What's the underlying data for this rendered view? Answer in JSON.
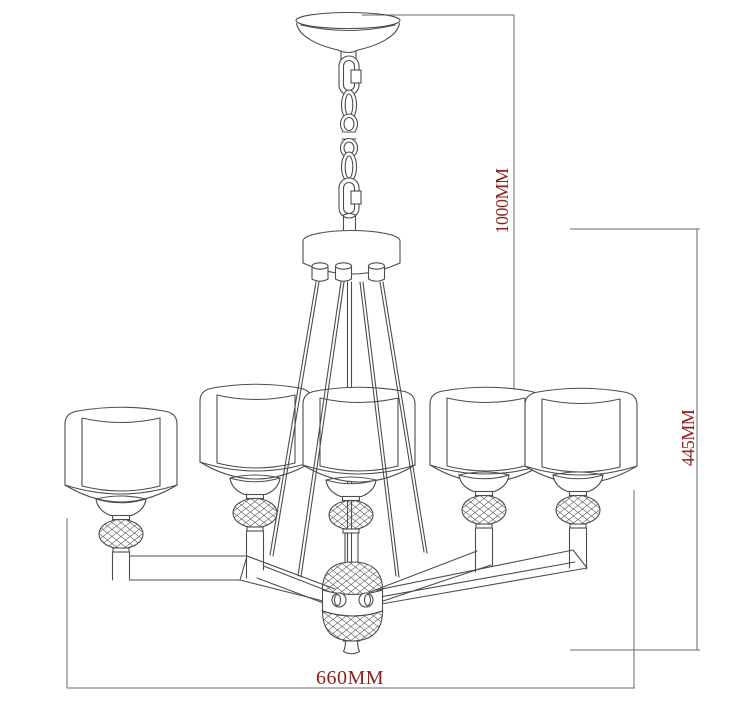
{
  "diagram": {
    "title": "chandelier-dimension-drawing",
    "type": "technical line drawing",
    "style": {
      "background": "#ffffff",
      "line_color": "#4d4d4d",
      "dimension_line_color": "#6a6a6a",
      "dimension_text_color": "#8f2020"
    },
    "dimensions": {
      "overall_drop": {
        "label": "1000MM",
        "orientation": "vertical"
      },
      "body_height": {
        "label": "445MM",
        "orientation": "vertical"
      },
      "body_width": {
        "label": "660MM",
        "orientation": "horizontal"
      }
    },
    "components": [
      "ceiling-canopy",
      "suspension-chain-with-quick-links",
      "central-hub",
      "support-rods",
      "drum-shades-x5",
      "crystal-ball-holders-x5",
      "curved-arms",
      "central-crystal-body",
      "bottom-finial"
    ],
    "shade_count": 5
  }
}
